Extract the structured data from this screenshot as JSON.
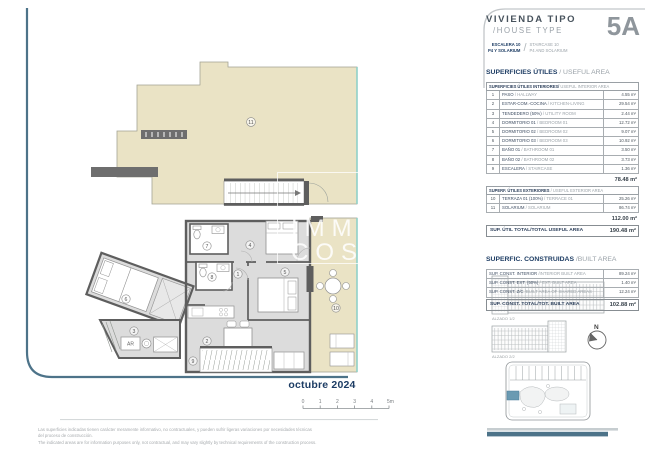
{
  "title": {
    "es": "VIVIENDA TIPO",
    "en": "/HOUSE TYPE",
    "type_code": "5A",
    "sub_es_line1": "ESCALERA 10",
    "sub_es_line2": "P4 Y SOLARIUM",
    "sub_slash": "/",
    "sub_en_line1": "STAIRCASE 10",
    "sub_en_line2": "P4 AND SOLARIUM"
  },
  "useful_area": {
    "section_title_es": "SUPERFICIES ÚTILES",
    "section_title_en": " / USEFUL AREA",
    "interior": {
      "header_es": "SUPERFICIES ÚTILES INTERIORES/",
      "header_en": " USEFUL INTERIOR AREA",
      "rows": [
        {
          "num": "1",
          "es": "PASO",
          "en": "/ HALLWAY",
          "value": "4.55 m²"
        },
        {
          "num": "2",
          "es": "ESTAR-COM.-COCINA",
          "en": "/ KITCHEN-LIVING",
          "value": "29.54 m²"
        },
        {
          "num": "3",
          "es": "TENDEDERO (50%)",
          "en": "/ UTILITY ROOM",
          "value": "2.44 m²"
        },
        {
          "num": "4",
          "es": "DORMITORIO 01",
          "en": "/ BEDROOM 01",
          "value": "12.72 m²"
        },
        {
          "num": "5",
          "es": "DORMITORIO 02",
          "en": "/ BEDROOM 02",
          "value": "9.07 m²"
        },
        {
          "num": "6",
          "es": "DORMITORIO 03",
          "en": "/ BEDROOM 03",
          "value": "10.92 m²"
        },
        {
          "num": "7",
          "es": "BAÑO 01",
          "en": "/ BATHROOM 01",
          "value": "3.50 m²"
        },
        {
          "num": "8",
          "es": "BAÑO 02",
          "en": "/ BATHROOM 02",
          "value": "3.73 m²"
        },
        {
          "num": "9",
          "es": "ESCALERA",
          "en": "/ STAIRCASE",
          "value": "1.36 m²"
        }
      ],
      "total": "78.48 m²"
    },
    "exterior": {
      "header_es": "SUPERF. ÚTILES EXTERIORES",
      "header_en": " / USEFUL EXTERIOR AREA",
      "rows": [
        {
          "num": "10",
          "es": "TERRAZA 01 (100%)",
          "en": "/ TERRACE 01",
          "value": "25.26 m²"
        },
        {
          "num": "11",
          "es": "SOLARIUM",
          "en": "/ SOLARIUM",
          "value": "86.74 m²"
        }
      ],
      "total": "112.00 m²"
    },
    "grand_total_label": "SUP. ÚTIL TOTAL/TOTAL USEFUL AREA",
    "grand_total_value": "190.48 m²"
  },
  "built_area": {
    "section_title_es": "SUPERFIC. CONSTRUIDAS",
    "section_title_en": " /BUILT AREA",
    "rows": [
      {
        "es": "SUP. CONST. INTERIOR",
        "en": "/INTERIOR BUILT AREA",
        "value": "89.24 m²"
      },
      {
        "es": "SUP. CONST. EXT. (50%)",
        "en": "/ EXT. BUILT AREA",
        "value": "1.40 m²"
      },
      {
        "es": "SUP. CONST. Z/C",
        "en": "/BUILT AREA OF SHARED AREAS",
        "value": "12.24 m²"
      }
    ],
    "total_label": "SUP. CONST. TOTAL/TOT. BUILT AREA",
    "total_value": "102.88 m²"
  },
  "plan": {
    "date": "octubre 2024",
    "watermark_line1": "IMMO",
    "watermark_line2": "COSTA",
    "ar_label": "AR",
    "room_numbers": [
      "1",
      "2",
      "3",
      "4",
      "5",
      "6",
      "7",
      "8",
      "9",
      "10",
      "11"
    ],
    "scale_ticks": [
      "0",
      "1",
      "2",
      "3",
      "4",
      "5m"
    ],
    "elevation1_label": "ALZADO 1/2",
    "elevation2_label": "ALZADO 2/2",
    "compass_n": "N"
  },
  "footer": {
    "disclaimer_es_line1": "Las superficies indicadas tienen carácter meramente informativo, no contractuales, y pueden sufrir ligeras variaciones por necesidades técnicas",
    "disclaimer_es_line2": "del proceso de construcción.",
    "disclaimer_en": "The indicated areas are for information purposes only, not contractual, and may vary slightly by technical requirements of the construction process."
  },
  "colors": {
    "accent_teal": "#4d7389",
    "navy": "#1c3c64",
    "floor_beige": "#eae3c5",
    "floor_gray": "#dcdcdc",
    "wall_gray": "#5e5e5e",
    "glass_teal": "#8fd0c8",
    "unit_highlight_blue": "#6a9ab2"
  }
}
